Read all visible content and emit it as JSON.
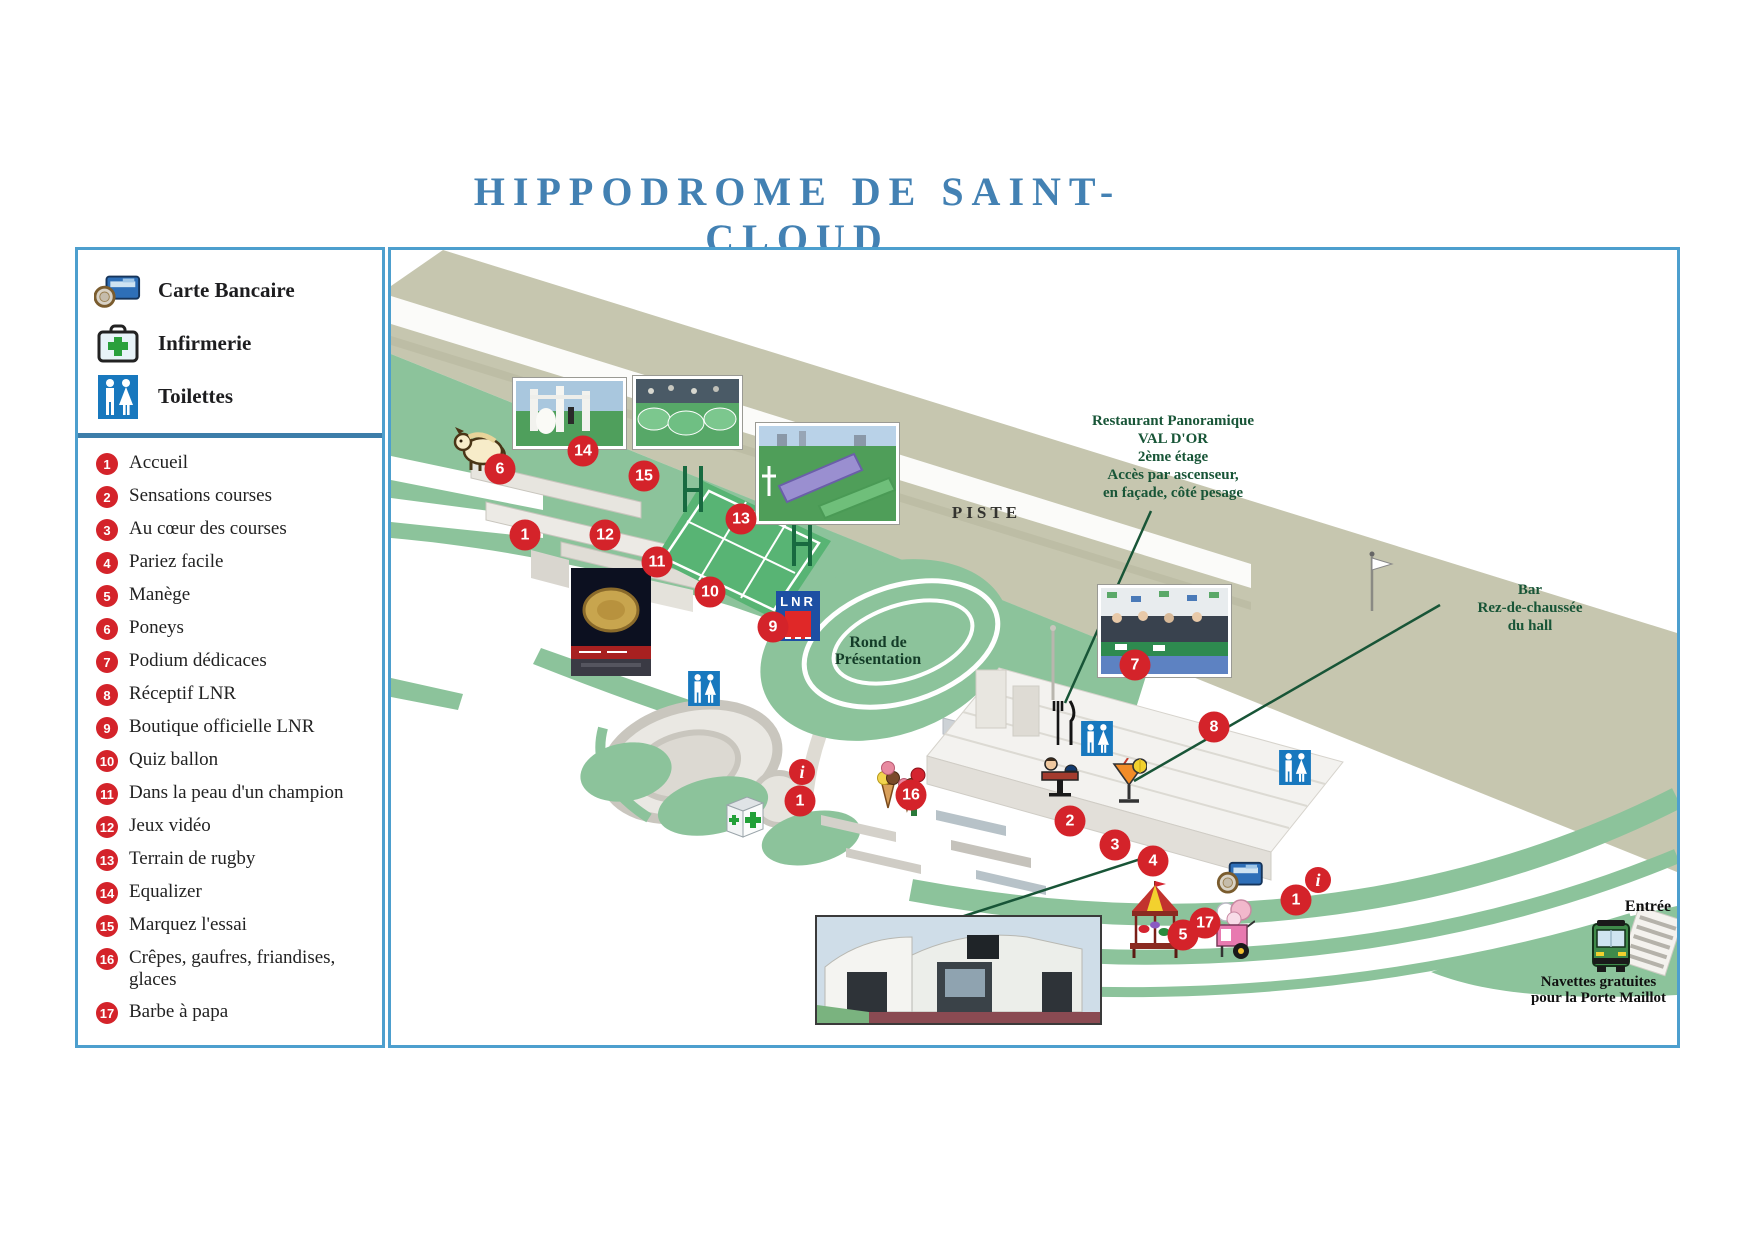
{
  "title": "HIPPODROME DE SAINT-CLOUD",
  "legend": {
    "services": [
      {
        "icon": "credit-card-icon",
        "label": "Carte Bancaire"
      },
      {
        "icon": "first-aid-icon",
        "label": "Infirmerie"
      },
      {
        "icon": "toilets-icon",
        "label": "Toilettes"
      }
    ],
    "items": [
      {
        "num": "1",
        "label": "Accueil"
      },
      {
        "num": "2",
        "label": "Sensations courses"
      },
      {
        "num": "3",
        "label": "Au cœur des courses"
      },
      {
        "num": "4",
        "label": "Pariez facile"
      },
      {
        "num": "5",
        "label": "Manège"
      },
      {
        "num": "6",
        "label": "Poneys"
      },
      {
        "num": "7",
        "label": "Podium dédicaces"
      },
      {
        "num": "8",
        "label": "Réceptif LNR"
      },
      {
        "num": "9",
        "label": "Boutique officielle LNR"
      },
      {
        "num": "10",
        "label": "Quiz ballon"
      },
      {
        "num": "11",
        "label": "Dans la peau d'un champion"
      },
      {
        "num": "12",
        "label": "Jeux vidéo"
      },
      {
        "num": "13",
        "label": "Terrain de rugby"
      },
      {
        "num": "14",
        "label": "Equalizer"
      },
      {
        "num": "15",
        "label": "Marquez l'essai"
      },
      {
        "num": "16",
        "label": "Crêpes, gaufres, friandises, glaces"
      },
      {
        "num": "17",
        "label": "Barbe à papa"
      }
    ]
  },
  "map": {
    "labels": {
      "piste": "PISTE",
      "rond": [
        "Rond de",
        "Présentation"
      ],
      "restaurant": [
        "Restaurant Panoramique",
        "VAL D'OR",
        "2ème étage",
        "Accès par ascenseur,",
        "en façade, côté pesage"
      ],
      "bar": [
        "Bar",
        "Rez-de-chaussée",
        "du hall"
      ],
      "entree": "Entrée",
      "navettes": [
        "Navettes gratuites",
        "pour la Porte Maillot"
      ],
      "lnr": "LNR"
    },
    "markers": [
      {
        "label": "6"
      },
      {
        "label": "14"
      },
      {
        "label": "15"
      },
      {
        "label": "13"
      },
      {
        "label": "1"
      },
      {
        "label": "12"
      },
      {
        "label": "11"
      },
      {
        "label": "10"
      },
      {
        "label": "9"
      },
      {
        "label": "7"
      },
      {
        "label": "8"
      },
      {
        "label": "i"
      },
      {
        "label": "1"
      },
      {
        "label": "16"
      },
      {
        "label": "2"
      },
      {
        "label": "3"
      },
      {
        "label": "4"
      },
      {
        "label": "5"
      },
      {
        "label": "17"
      },
      {
        "label": "1"
      },
      {
        "label": "i"
      }
    ]
  },
  "colors": {
    "panel_border": "#4d9fce",
    "divider_blue": "#3c7da9",
    "title_blue": "#4381b3",
    "marker_red": "#d4232a",
    "annotation_green": "#185537",
    "piste_khaki": "#c6c6af",
    "grass_green": "#8cc39b"
  }
}
